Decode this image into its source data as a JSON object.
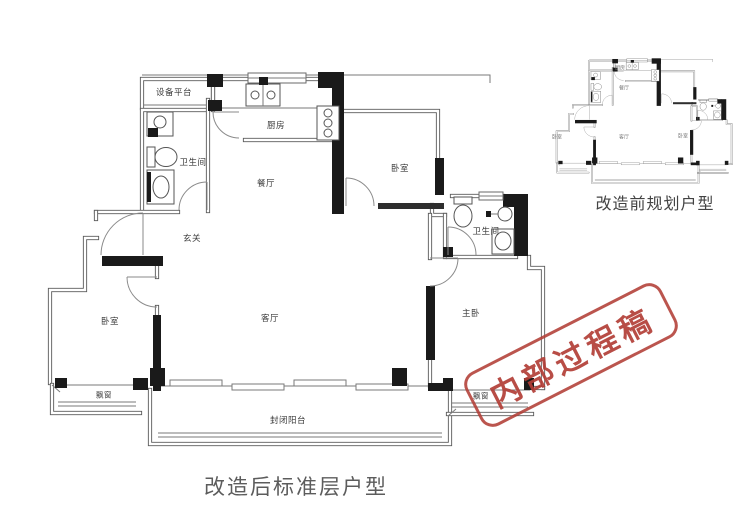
{
  "main_plan": {
    "caption": "改造后标准层户型",
    "rooms": {
      "equipment_platform": "设备平台",
      "bathroom_left": "卫生间",
      "kitchen": "厨房",
      "dining": "餐厅",
      "foyer": "玄关",
      "bedroom_top_right": "卧室",
      "bathroom_right": "卫生间",
      "living": "客厅",
      "bedroom_left": "卧室",
      "master_bedroom": "主卧",
      "bay_window_left": "飘窗",
      "bay_window_right": "飘窗",
      "balcony": "封闭阳台"
    }
  },
  "mini_plan": {
    "caption": "改造前规划户型",
    "rooms": {
      "kitchen": "厨房",
      "dining": "餐厅",
      "living": "客厅",
      "bedroom_left": "卧室",
      "bedroom_right": "卧室"
    }
  },
  "stamp": {
    "text": "内部过程稿",
    "color": "#b23e36"
  },
  "colors": {
    "wall_structural": "#1a1a1a",
    "wall_line": "#5a5a5a",
    "label_text": "#3a3a3a",
    "caption_text": "#5c5c5c",
    "stamp_red": "#b23e36",
    "background": "#ffffff"
  }
}
